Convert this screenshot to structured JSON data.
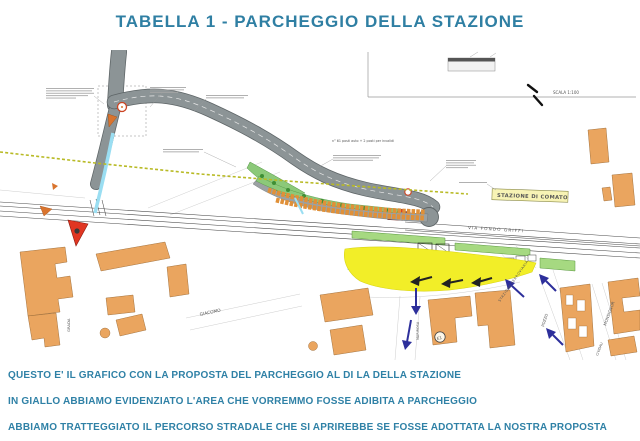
{
  "title": "TABELLA 1 - PARCHEGGIO DELLA STAZIONE",
  "notes": {
    "line1": "QUESTO E' IL GRAFICO CON LA PROPOSTA DEL PARCHEGGIO AL DI LA DELLA STAZIONE",
    "line2": "IN GIALLO ABBIAMO EVIDENZIATO L'AREA CHE VORREMMO FOSSE ADIBITA A PARCHEGGIO",
    "line3": "ABBIAMO TRATTEGGIATO IL PERCORSO STRADALE CHE SI APRIREBBE SE FOSSE ADOTTATA LA NOSTRA PROPOSTA"
  },
  "map": {
    "scale_label": "SCALA 1:100",
    "station_sign": "STAZIONE DI COMATO",
    "road_name": "VIA FONDO GRIFFI",
    "station_area_label": "STAZIONE FERROVIARIA",
    "parking_note": "n° 61 posti auto + 2 posti per invalidi",
    "marker_e1": "E1",
    "platform_badge": "2",
    "streets": {
      "pozzo": "POZZO",
      "monsignor": "MONSIGNOR",
      "cividali": "CIVIDALI",
      "giacomo": "GIACOMO",
      "grada": "GRADA",
      "marirosa": "MARIROSA"
    },
    "colors": {
      "proposal_yellow": "#f2ee28",
      "route_blue": "#2d2f9b",
      "road_gray": "#8c9496",
      "building_orange": "#eaa55f",
      "building_red": "#e03622",
      "platform_green": "#a6d981",
      "text_teal": "#2f7fa3",
      "survey_yellow": "#b8ba25",
      "sign_background": "#f7f3b5",
      "stream_cyan": "#9adef2"
    }
  }
}
